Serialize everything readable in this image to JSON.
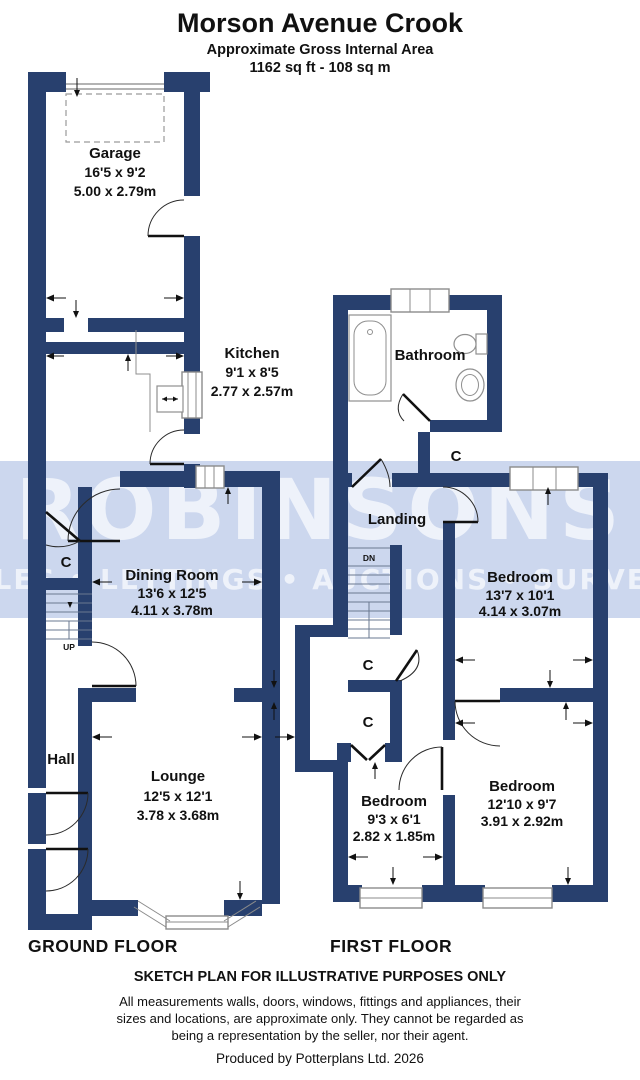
{
  "header": {
    "title": "Morson Avenue Crook",
    "subtitle": "Approximate Gross Internal Area",
    "area": "1162 sq ft - 108 sq m"
  },
  "watermark": {
    "name": "ROBINSONS",
    "tagline": "SALES • LETTINGS • AUCTIONS • SURVEYS"
  },
  "colors": {
    "wall": "#28406e",
    "band": "#ccd7ee",
    "wmtext": "#eef2fa"
  },
  "ground_floor": {
    "label": "GROUND FLOOR",
    "garage": {
      "name": "Garage",
      "imperial": "16'5 x 9'2",
      "metric": "5.00 x 2.79m"
    },
    "kitchen": {
      "name": "Kitchen",
      "imperial": "9'1 x 8'5",
      "metric": "2.77 x 2.57m"
    },
    "dining": {
      "name": "Dining Room",
      "imperial": "13'6 x 12'5",
      "metric": "4.11 x 3.78m"
    },
    "lounge": {
      "name": "Lounge",
      "imperial": "12'5 x 12'1",
      "metric": "3.78 x 3.68m"
    },
    "hall": {
      "name": "Hall"
    },
    "closet": {
      "label": "C"
    },
    "stairs": {
      "label": "UP"
    }
  },
  "first_floor": {
    "label": "FIRST FLOOR",
    "bathroom": {
      "name": "Bathroom"
    },
    "landing": {
      "name": "Landing"
    },
    "bedroom1": {
      "name": "Bedroom",
      "imperial": "13'7 x 10'1",
      "metric": "4.14 x 3.07m"
    },
    "bedroom2": {
      "name": "Bedroom",
      "imperial": "12'10 x 9'7",
      "metric": "3.91 x 2.92m"
    },
    "bedroom3": {
      "name": "Bedroom",
      "imperial": "9'3 x 6'1",
      "metric": "2.82 x 1.85m"
    },
    "closet_top": {
      "label": "C"
    },
    "closet_mid": {
      "label": "C"
    },
    "closet_lower": {
      "label": "C"
    },
    "stairs": {
      "label": "DN"
    }
  },
  "footer": {
    "disclaimer_title": "SKETCH PLAN FOR ILLUSTRATIVE PURPOSES ONLY",
    "disclaimer_lines": [
      "All measurements walls, doors, windows, fittings and appliances, their",
      "sizes and locations, are approximate only. They cannot be regarded as",
      "being a representation by the seller, nor their agent."
    ],
    "credit": "Produced by Potterplans Ltd. 2026"
  }
}
